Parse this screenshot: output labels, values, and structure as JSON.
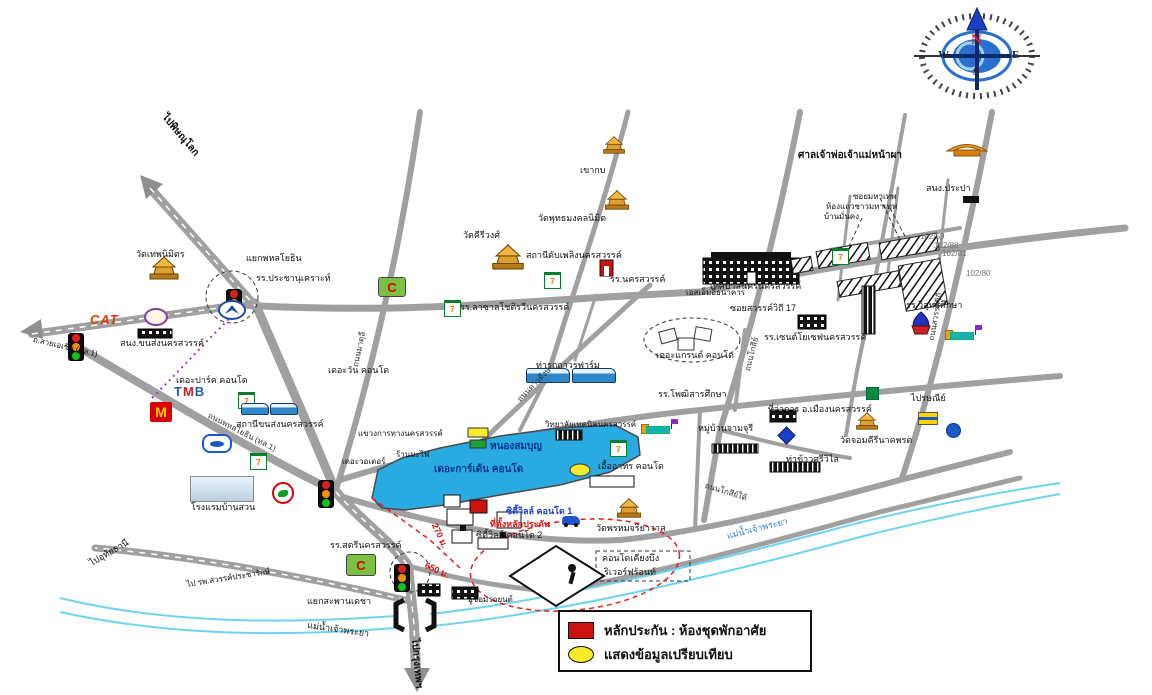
{
  "compass": {
    "n": "N",
    "e": "E",
    "w": "W",
    "s": "S"
  },
  "legend": {
    "collateral_label": "หลักประกัน : ห้องชุดพักอาศัย",
    "comparison_label": "แสดงข้อมูลเปรียบเทียบ"
  },
  "icons": {
    "seven_eleven": "7",
    "mcdonalds": "M",
    "big_c": "C",
    "cat": "CAT",
    "tmb_t": "T",
    "tmb_m": "M",
    "tmb_b": "B",
    "mazda": "mazda"
  },
  "colors": {
    "road": "#a0a0a0",
    "lake": "#29abe2",
    "river": "#6fd4f0",
    "collateral_red": "#cc1111",
    "comparison_yellow": "#f7ec2a",
    "route_dash_red": "#e02020"
  },
  "labels": {
    "pai_phitsanulok": "ไปพิษณุโลก",
    "asia_rd": "ถ.สายเอเชีย (ทล.1)",
    "yaek_phahon": "แยกพหลโยธิน",
    "prachanukroh": "รร.ประชานุเคราะห์",
    "wat_thepnimit": "วัดเทพนิมิตร",
    "songkan": "สนง.ขนส่งนครสวรรค์",
    "khaokob": "เขากบ",
    "wat_putta": "วัดพุทธมงคลนิมิต",
    "sanchao": "ศาลเจ้าพ่อเจ้าแม่หน้าผา",
    "prapa": "สนง.ประปา",
    "soi_mahathep": "ซอยมหาเทพ",
    "rowhouse": "ห้องแถวชาวมหาเทพ",
    "baan_mankong": "บ้านมั่นคง",
    "no1": "102/59",
    "no2": "102/88",
    "no3": "102/81",
    "no4": "102/80",
    "wat_kiriwong": "วัดคีรีวงศ์",
    "fire_station": "สถานีดับเพลิงนครสวรรค์",
    "school_ns": "รร.นครสวรรค์",
    "lasalle": "รร.ลาซาลโชติรวีนครสวรรค์",
    "city_hall": "เทศบาลนครนครสวรรค์",
    "sme_bank": "เอสเอ็มอีธนาคาร",
    "soi17": "ซอยสวรรค์วิถี 17",
    "stjoseph": "รร.เซนต์โยเซฟนครสวรรค์",
    "grand_condo": "เดอะแกรนด์ คอนโด",
    "thaworn": "ท่ารถถาวรฟาร์ม",
    "photisarn": "รร.โพฒิสารศึกษา",
    "jamjuree": "หมู่บ้านจามจุรี",
    "amphoe": "ที่ว่าการ อ.เมืองนครสวรรค์",
    "takaw": "ท่าข้าวศรีวิไล",
    "visut": "รร.วิสุทธิศึกษา",
    "post": "ไปรษณีย์",
    "wat_jomkiri": "วัดจอมคีรีนาคพรต",
    "the_park": "เดอะปาร์ค คอนโด",
    "the_one": "เดอะวัน คอนโด",
    "bus_terminal": "สถานีขนส่งนครสวรรค์",
    "kwang_thang": "แขวงการทางนครสวรรค์",
    "ban_mafai": "ร้านมะไฟ",
    "nong_sombun": "หนองสมบุญ",
    "garden_condo": "เดอะการ์เด้น คอนโด",
    "technic": "วิทยาลัยเทคนิคนครสวรรค์",
    "uea_athon": "เอื้ออาทร คอนโด",
    "the_water": "เดอะวอเตอร์",
    "baan_suan": "โรงแรมบ้านสวน",
    "satri": "รร.สตรีนครสวรรค์",
    "cityville1": "ซิตี้วิลล์ คอนโด 1",
    "site": "ที่ตั้งหลักประกัน",
    "cityville2": "ซิตี้วิลล์ คอนโด 2",
    "wat_phrom": "วัดพรหมจริยาวาส",
    "d270": "270 ม.",
    "d650": "650 ม.",
    "kieng1": "คอนโดเคียงบึง",
    "kieng2": "ริเวอร์ฟร้อนท์",
    "garage": "อู่ซ่อมรถยนต์",
    "yaek_decha": "แยกสะพานเดชา",
    "pai_hosp": "ไป รพ.สวรรค์ประชารักษ์",
    "pai_uthai": "ไปอุทัยธานี",
    "river_w": "แม่น้ำเจ้าพระยา",
    "river_e": "แม่น้ำเจ้าพระยา",
    "pai_bkk": "ไปกรุงเทพฯ",
    "rd_phahon": "ถนนพหลโยธิน (ทล.1)",
    "rd_matuli": "ถนนมาตุลี",
    "rd_dao": "ถนนดาวดึงษ์",
    "rd_kosi": "ถนนโกสีย์",
    "rd_sawan": "ถนนสวรรค์วิถี",
    "rd_kosi_tai": "ถนนโกสีย์ใต้"
  }
}
